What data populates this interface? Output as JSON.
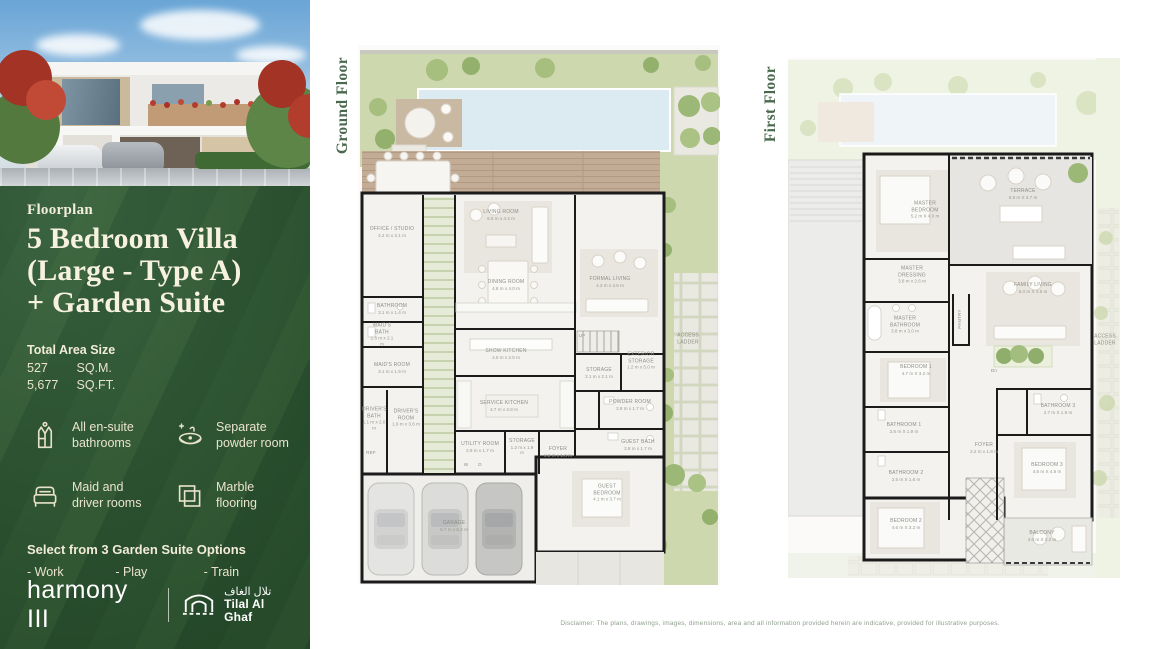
{
  "sidebar": {
    "label": "Floorplan",
    "title_line1": "5 Bedroom Villa",
    "title_line2": "(Large - Type A)",
    "title_line3": "+ Garden Suite",
    "area": {
      "heading": "Total Area Size",
      "rows": [
        {
          "value": "527",
          "unit": "SQ.M."
        },
        {
          "value": "5,677",
          "unit": "SQ.FT."
        }
      ]
    },
    "features": [
      {
        "icon": "bathrobe-icon",
        "line1": "All en-suite",
        "line2": "bathrooms"
      },
      {
        "icon": "sink-icon",
        "line1": "Separate",
        "line2": "powder room"
      },
      {
        "icon": "bed-icon",
        "line1": "Maid and",
        "line2": "driver rooms"
      },
      {
        "icon": "marble-tiles-icon",
        "line1": "Marble",
        "line2": "flooring"
      }
    ],
    "garden_suite": {
      "heading": "Select from 3 Garden Suite Options",
      "options": [
        "- Work",
        "- Play",
        "- Train"
      ]
    },
    "brand": {
      "harmony": "harmony III",
      "tilal_icon": "arch-gate-icon",
      "tilal_arabic": "تلال الغاف",
      "tilal_english": "Tilal Al Ghaf"
    },
    "accent_green": "#2e5a33",
    "cream": "#ece6cf"
  },
  "plans": {
    "ground": {
      "label": "Ground Floor",
      "rooms": [
        {
          "n": "OFFICE / STUDIO",
          "d": "4.2 m x 3.1 m",
          "x": 34,
          "y": 187
        },
        {
          "n": "BATHROOM",
          "d": "3.1 m x 1.4 m",
          "x": 34,
          "y": 264
        },
        {
          "n": "MAID'S BATH",
          "d": "1.6 m x 2.1 m",
          "x": 24,
          "y": 290,
          "w": 26
        },
        {
          "n": "MAID'S ROOM",
          "d": "3.1 m x 1.9 m",
          "x": 34,
          "y": 323
        },
        {
          "n": "DRIVER'S BATH",
          "d": "1.1 m x 2.0 m",
          "x": 16,
          "y": 374,
          "w": 24
        },
        {
          "n": "DRIVER'S ROOM",
          "d": "1.9 m x 3.6 m",
          "x": 48,
          "y": 373,
          "w": 30
        },
        {
          "n": "REF",
          "x": 13,
          "y": 408,
          "cls": "tiny"
        },
        {
          "n": "LIVING ROOM",
          "d": "6.5 m x 4.4 m",
          "x": 143,
          "y": 170
        },
        {
          "n": "DINING ROOM",
          "d": "4.8 m x 4.0 m",
          "x": 148,
          "y": 240
        },
        {
          "n": "SHOW KITCHEN",
          "d": "4.0 m x 2.5 m",
          "x": 148,
          "y": 309
        },
        {
          "n": "SERVICE KITCHEN",
          "d": "4.7 m x 2.8 m",
          "x": 146,
          "y": 361
        },
        {
          "n": "UTILITY ROOM",
          "d": "2.9 m x 1.7 m",
          "x": 122,
          "y": 402
        },
        {
          "n": "STORAGE",
          "d": "1.2 m x 1.9 m",
          "x": 164,
          "y": 402,
          "w": 26
        },
        {
          "n": "W",
          "x": 108,
          "y": 420,
          "cls": "tiny"
        },
        {
          "n": "D",
          "x": 122,
          "y": 420,
          "cls": "tiny"
        },
        {
          "n": "FORMAL LIVING",
          "d": "4.3 m x 4.6 m",
          "x": 252,
          "y": 237
        },
        {
          "n": "UP",
          "x": 224,
          "y": 291,
          "cls": "tiny"
        },
        {
          "n": "STORAGE",
          "d": "2.1 m x 2.1 m",
          "x": 241,
          "y": 328
        },
        {
          "n": "EXTERIOR STORAGE",
          "d": "1.2 m x 5.0 m",
          "x": 283,
          "y": 316,
          "w": 34
        },
        {
          "n": "POWDER ROOM",
          "d": "2.8 m x 1.7 m",
          "x": 272,
          "y": 360
        },
        {
          "n": "FOYER",
          "d": "2.2 m x 1.8 m",
          "x": 200,
          "y": 407
        },
        {
          "n": "GUEST BATH",
          "d": "2.8 m x 1.7 m",
          "x": 280,
          "y": 400
        },
        {
          "n": "GUEST BEDROOM",
          "d": "4.1 m x 3.7 m",
          "x": 249,
          "y": 448,
          "w": 36
        },
        {
          "n": "GARAGE",
          "d": "9.7 m x 6.2 m",
          "x": 96,
          "y": 481
        },
        {
          "n": "ACCESS LADDER",
          "x": 330,
          "y": 294,
          "w": 28
        }
      ]
    },
    "first": {
      "label": "First Floor",
      "rooms": [
        {
          "n": "MASTER BEDROOM",
          "d": "5.2 m X 4.0 m",
          "x": 137,
          "y": 152,
          "w": 38
        },
        {
          "n": "TERRACE",
          "d": "5.9 m X 3.7 m",
          "x": 235,
          "y": 136
        },
        {
          "n": "MASTER DRESSING",
          "d": "3.8 m x 2.6 m",
          "x": 124,
          "y": 217,
          "w": 38
        },
        {
          "n": "MASTER BATHROOM",
          "d": "3.8 m x 3.0 m",
          "x": 117,
          "y": 267,
          "w": 40
        },
        {
          "n": "FAMILY LIVING",
          "d": "5.0 m X 4.5 m",
          "x": 245,
          "y": 230
        },
        {
          "n": "PANTRY",
          "x": 172,
          "y": 261,
          "rot": -90,
          "cls": "tiny"
        },
        {
          "n": "BEDROOM 1",
          "d": "4.7 m X 3.2 m",
          "x": 128,
          "y": 312
        },
        {
          "n": "BATHROOM 1",
          "d": "2.5 m X 1.9 m",
          "x": 116,
          "y": 370
        },
        {
          "n": "BATHROOM 2",
          "d": "2.5 m X 1.6 m",
          "x": 118,
          "y": 418
        },
        {
          "n": "BEDROOM 2",
          "d": "4.6 m X 3.2 m",
          "x": 118,
          "y": 466
        },
        {
          "n": "BATHROOM 3",
          "d": "2.7 m X 1.9 m",
          "x": 270,
          "y": 351
        },
        {
          "n": "BEDROOM 3",
          "d": "4.6 m X 4.6 m",
          "x": 259,
          "y": 410
        },
        {
          "n": "BALCONY",
          "d": "4.0 m X 2.2 m",
          "x": 254,
          "y": 478
        },
        {
          "n": "FOYER",
          "d": "2.2 m x 1.8 m",
          "x": 196,
          "y": 390
        },
        {
          "n": "Dn",
          "x": 206,
          "y": 313,
          "cls": "tiny"
        },
        {
          "n": "ACCESS LADDER",
          "x": 317,
          "y": 282,
          "w": 28
        }
      ]
    }
  },
  "disclaimer": "Disclaimer: The plans, drawings, images, dimensions, area and all information provided herein are indicative, provided for illustrative purposes."
}
